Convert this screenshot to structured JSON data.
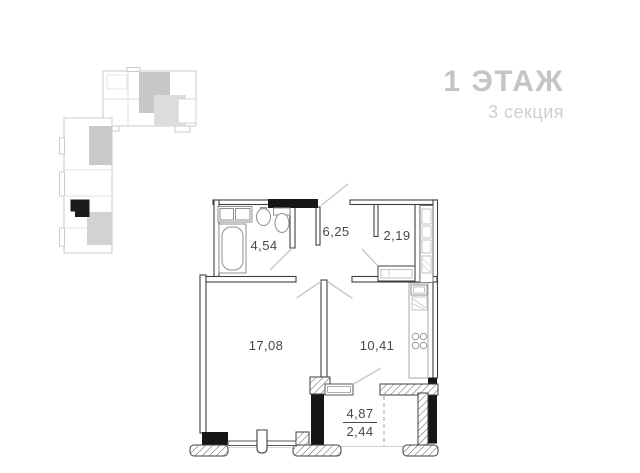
{
  "header": {
    "title": "1 ЭТАЖ",
    "subtitle": "3 секция"
  },
  "floor_plan": {
    "rooms": [
      {
        "name": "bathroom",
        "area": "4,54"
      },
      {
        "name": "hallway",
        "area": "6,25"
      },
      {
        "name": "wardrobe",
        "area": "2,19"
      },
      {
        "name": "living-room",
        "area": "17,08"
      },
      {
        "name": "kitchen",
        "area": "10,41"
      },
      {
        "name": "balcony",
        "area": "4,87",
        "area_reduced": "2,44"
      }
    ],
    "fixtures": [
      "bathtub",
      "toilet",
      "sink",
      "washing-machine",
      "kitchen-sink",
      "stove"
    ]
  },
  "site_plan": {
    "highlighted_unit": "current-apartment",
    "marker_color": "#1b1b1b"
  },
  "colors": {
    "wall": "#3f3f3f",
    "solid_fill": "#161616",
    "label": "#48484a",
    "title": "#c5c5c9",
    "subtitle": "#cfcfd3",
    "site_outline": "#cbcbcb"
  }
}
